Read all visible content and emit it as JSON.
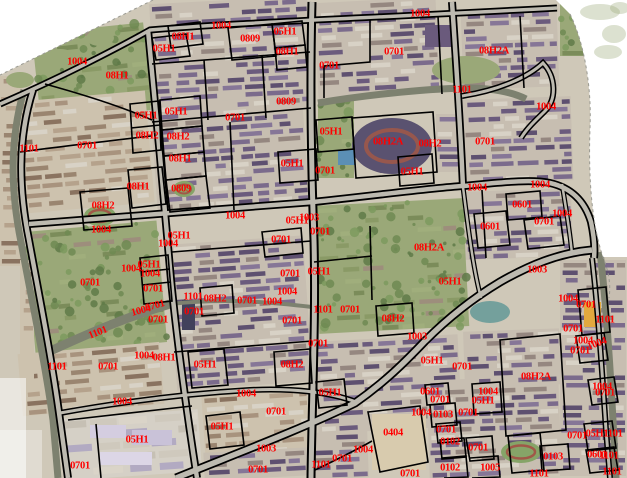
{
  "map": {
    "description": "Cadastral parcel code map overlaid on aerial orthophoto",
    "label_color": "#ff0000",
    "boundary_color": "#000000",
    "background_color": "#ffffff",
    "road_fill": "#bdbab0",
    "canal_fill": "#7d816f",
    "ground_fill": "#cfc8b8",
    "labels": [
      [
        "1004",
        77,
        62
      ],
      [
        "08H1",
        117,
        76
      ],
      [
        "05H1",
        164,
        49
      ],
      [
        "08H1",
        183,
        37
      ],
      [
        "1004",
        221,
        26
      ],
      [
        "0809",
        250,
        39
      ],
      [
        "05H1",
        285,
        32
      ],
      [
        "08H1",
        287,
        52
      ],
      [
        "0701",
        329,
        66
      ],
      [
        "1004",
        420,
        14
      ],
      [
        "0701",
        394,
        52
      ],
      [
        "08H2A",
        494,
        51
      ],
      [
        "1101",
        462,
        90
      ],
      [
        "1004",
        546,
        107
      ],
      [
        "0809",
        286,
        102
      ],
      [
        "05H1",
        146,
        116
      ],
      [
        "05H1",
        176,
        112
      ],
      [
        "0701",
        235,
        118
      ],
      [
        "08H2",
        147,
        136
      ],
      [
        "08H2",
        178,
        137
      ],
      [
        "1101",
        29,
        149
      ],
      [
        "0701",
        87,
        146
      ],
      [
        "08H1",
        180,
        159
      ],
      [
        "05H1",
        331,
        132
      ],
      [
        "08H2A",
        388,
        142
      ],
      [
        "08H2",
        430,
        144
      ],
      [
        "0701",
        485,
        142
      ],
      [
        "05H1",
        292,
        164
      ],
      [
        "0701",
        325,
        171
      ],
      [
        "05H1",
        412,
        172
      ],
      [
        "08H1",
        138,
        187
      ],
      [
        "0809",
        181,
        189
      ],
      [
        "1004",
        477,
        188
      ],
      [
        "1004",
        540,
        185
      ],
      [
        "08H2",
        103,
        206
      ],
      [
        "0601",
        522,
        205
      ],
      [
        "1004",
        562,
        214
      ],
      [
        "0701",
        544,
        222
      ],
      [
        "1004",
        235,
        216
      ],
      [
        "1003",
        309,
        218
      ],
      [
        "05H1",
        297,
        221
      ],
      [
        "0601",
        490,
        227
      ],
      [
        "1004",
        101,
        230
      ],
      [
        "05H1",
        179,
        236
      ],
      [
        "0701",
        281,
        240
      ],
      [
        "1004",
        168,
        244
      ],
      [
        "0701",
        320,
        232
      ],
      [
        "08H2A",
        429,
        248
      ],
      [
        "05H1",
        149,
        265
      ],
      [
        "1004",
        131,
        269
      ],
      [
        "1003",
        537,
        270
      ],
      [
        "05H1",
        319,
        272
      ],
      [
        "1004",
        150,
        274
      ],
      [
        "0701",
        290,
        274
      ],
      [
        "0701",
        90,
        283
      ],
      [
        "05H1",
        450,
        282
      ],
      [
        "0701",
        153,
        289
      ],
      [
        "1004",
        287,
        292
      ],
      [
        "1101",
        193,
        297
      ],
      [
        "08H2",
        215,
        299
      ],
      [
        "1004",
        568,
        299
      ],
      [
        "0701",
        247,
        301
      ],
      [
        "1004",
        272,
        302
      ],
      [
        "0701",
        586,
        305
      ],
      [
        "0701",
        155,
        306,
        -15
      ],
      [
        "1101",
        323,
        310
      ],
      [
        "0701",
        350,
        310
      ],
      [
        "1004",
        141,
        311,
        -15
      ],
      [
        "0701",
        194,
        312
      ],
      [
        "08H2",
        393,
        319
      ],
      [
        "1101",
        605,
        320
      ],
      [
        "0701",
        158,
        320
      ],
      [
        "0701",
        292,
        321
      ],
      [
        "0701",
        573,
        329
      ],
      [
        "1101",
        98,
        333,
        -22
      ],
      [
        "1003",
        417,
        337
      ],
      [
        "1004",
        583,
        341
      ],
      [
        "1004",
        597,
        344,
        -20
      ],
      [
        "0701",
        318,
        344
      ],
      [
        "0701",
        580,
        351
      ],
      [
        "1004",
        144,
        356
      ],
      [
        "08H1",
        164,
        358
      ],
      [
        "05H1",
        432,
        361
      ],
      [
        "05H1",
        205,
        365
      ],
      [
        "08H2",
        292,
        365
      ],
      [
        "1101",
        57,
        367
      ],
      [
        "0701",
        108,
        367
      ],
      [
        "0701",
        462,
        367
      ],
      [
        "08H2A",
        536,
        377
      ],
      [
        "1004",
        602,
        387
      ],
      [
        "05H1",
        330,
        393
      ],
      [
        "0601",
        430,
        392
      ],
      [
        "0701",
        605,
        393
      ],
      [
        "1004",
        246,
        394
      ],
      [
        "0701",
        440,
        400
      ],
      [
        "1004",
        488,
        392
      ],
      [
        "05H1",
        483,
        401
      ],
      [
        "1004",
        122,
        402
      ],
      [
        "0701",
        276,
        412
      ],
      [
        "1004",
        421,
        413
      ],
      [
        "0103",
        443,
        415
      ],
      [
        "0701",
        468,
        413
      ],
      [
        "05H1",
        222,
        427
      ],
      [
        "0701",
        446,
        430
      ],
      [
        "0404",
        393,
        433
      ],
      [
        "05H1",
        597,
        434
      ],
      [
        "1101",
        613,
        434
      ],
      [
        "0701",
        577,
        436
      ],
      [
        "05H1",
        137,
        440
      ],
      [
        "0102",
        450,
        442
      ],
      [
        "0701",
        478,
        448
      ],
      [
        "1003",
        266,
        449
      ],
      [
        "1004",
        363,
        450
      ],
      [
        "0601",
        597,
        455
      ],
      [
        "1101",
        609,
        456
      ],
      [
        "0103",
        553,
        457
      ],
      [
        "0701",
        342,
        459
      ],
      [
        "1101",
        321,
        465
      ],
      [
        "0701",
        80,
        466
      ],
      [
        "0102",
        450,
        468
      ],
      [
        "1005",
        490,
        468
      ],
      [
        "0701",
        258,
        470
      ],
      [
        "1101",
        612,
        472
      ],
      [
        "0701",
        410,
        474
      ],
      [
        "1101",
        539,
        474
      ]
    ],
    "roads": [
      [
        "M0,104 C60,78 118,48 150,30 C230,23 350,19 557,8",
        7,
        3.5
      ],
      [
        "M33,90 C17,140 19,190 29,240 C40,300 52,360 60,420 L68,478",
        8,
        4.5
      ],
      [
        "M148,30 C156,110 164,200 171,280 C178,350 188,420 197,478",
        8,
        4.5
      ],
      [
        "M312,2 C310,80 311,160 314,240 C316,320 312,400 311,478",
        9,
        5
      ],
      [
        "M452,2 C456,60 460,120 463,187",
        8,
        4.5
      ],
      [
        "M29,224 C120,217 220,209 313,202 C380,195 430,188 463,186 C505,182 532,179 550,183 C572,188 585,202 591,222 C594,236 595,248 594,258",
        8,
        4.5
      ],
      [
        "M176,478 C230,456 300,430 355,403 C385,382 405,362 425,341 C445,321 470,300 500,282 C528,266 558,253 592,250",
        9,
        5.5
      ],
      [
        "M60,413 C110,404 180,394 250,390 C292,388 330,392 356,402",
        6,
        3
      ],
      [
        "M592,258 C598,310 602,370 606,430 L610,478",
        6,
        3
      ],
      [
        "M462,96 C500,90 528,77 543,63 C556,77 557,99 545,111 C536,120 527,128 521,138",
        6,
        3
      ],
      [
        "M463,187 C469,235 474,272 481,298",
        5,
        2.5
      ],
      [
        "M562,184 C566,208 570,232 572,254",
        5,
        2.5
      ]
    ],
    "canals": [
      [
        "M24,90 C9,142 11,192 21,242 C32,302 45,362 53,420 L58,478",
        7
      ],
      [
        "M46,353 C85,335 126,317 170,304",
        9
      ],
      [
        "M170,304 C225,298 270,302 312,307",
        4
      ],
      [
        "M318,103 C360,96 420,89 465,88 C492,88 512,92 526,99",
        7
      ],
      [
        "M600,252 C607,310 611,380 614,440 L616,478",
        7
      ]
    ],
    "boundaries": [
      "M45,84 C85,95 125,108 152,120",
      "M152,38 L186,34 L190,56 L156,60 Z",
      "M168,26 L200,22 L203,44 L171,48 Z",
      "M20,152 C65,146 108,141 151,136",
      "M80,192 L128,188 L132,226 L84,230 Z",
      "M128,170 L162,167 L166,204 L132,208 Z",
      "M152,64 L310,52",
      "M228,28 L272,24 L276,56 L232,60 Z",
      "M272,24 L302,21 L305,45 L275,48 Z",
      "M275,48 L305,45 L307,67 L277,70 Z",
      "M152,122 L311,108",
      "M262,55 L266,118",
      "M204,60 L208,120",
      "M160,100 L200,96 L202,126 L162,130 Z",
      "M162,130 L202,126 L204,152 L164,156 Z",
      "M164,156 L204,152 L206,176 L166,180 Z",
      "M166,180 L206,176 L210,208 L170,212 Z",
      "M130,104 L159,101 L161,150 L133,153 Z",
      "M131,128 L160,125",
      "M230,122 L234,210",
      "M370,20 L370,62 L324,66 L324,98",
      "M438,16 L442,94",
      "M520,16 L524,88",
      "M352,118 L433,112 L437,172 L356,178 Z",
      "M316,120 L352,117 L354,149 L318,152 Z",
      "M398,157 L432,154 L434,183 L400,186 Z",
      "M278,152 L316,149 L318,180 L280,183 Z",
      "M482,190 L486,258",
      "M506,194 L540,191 L542,217 L508,220 Z",
      "M524,220 L560,216 L564,245 L528,249 Z",
      "M474,214 L506,211 L510,245 L478,248 Z",
      "M172,252 L311,241",
      "M200,288 L232,285 L234,313 L202,316 Z",
      "M262,232 L301,228 L303,253 L265,257 Z",
      "M140,258 L168,255 L172,301 L144,304 Z",
      "M141,272 L170,269",
      "M142,285 L171,282",
      "M174,352 L312,341",
      "M188,352 L224,349 L228,385 L192,388 Z",
      "M274,352 L310,349 L312,383 L276,386 Z",
      "M370,226 L372,300",
      "M376,306 L412,303 L414,333 L378,336 Z",
      "M314,262 L372,256",
      "M68,420 L192,406",
      "M96,424 L101,478",
      "M206,416 L240,412 L244,445 L210,449 Z",
      "M316,382 L344,379 L347,405 L319,408 Z",
      "M368,412 L420,406 L428,462 L380,472 Z",
      "M315,470 C340,458 358,449 372,441",
      "M425,385 L448,383 L450,403 L427,405 Z",
      "M430,405 L455,403 L457,425 L432,427 Z",
      "M436,424 L460,422 L462,441 L438,443 Z",
      "M440,440 L464,438 L466,457 L442,459 Z",
      "M442,458 L466,456 L468,477 L444,478",
      "M466,438 L492,436 L494,459 L470,461 Z",
      "M470,458 L498,456 L500,477 L472,478",
      "M472,384 L500,382 L502,412 L474,414 Z",
      "M500,340 L560,334 L566,430 L506,436 Z",
      "M540,446 L568,444 L570,469 L542,471 Z",
      "M508,436 L540,433 L544,470 L512,473 Z",
      "M578,290 L606,287 L610,332 L582,335 Z",
      "M576,336 L604,333 L608,360 L580,363 Z",
      "M588,380 L614,377 L618,402 L592,405 Z",
      "M584,424 L612,421 L616,448 L588,451 Z",
      "M586,450 L614,447 L618,470 L590,473 Z"
    ],
    "features": [
      {
        "type": "ellipse",
        "x": 20,
        "y": 80,
        "rx": 14,
        "ry": 8,
        "fill": "#9aa878",
        "name": "tree-patch"
      },
      {
        "type": "ellipse",
        "x": 60,
        "y": 58,
        "rx": 16,
        "ry": 9,
        "fill": "#9aa878",
        "name": "tree-patch"
      },
      {
        "type": "ellipse",
        "x": 100,
        "y": 38,
        "rx": 14,
        "ry": 8,
        "fill": "#9aa878",
        "name": "tree-patch"
      },
      {
        "type": "ellipse",
        "x": 466,
        "y": 70,
        "rx": 34,
        "ry": 14,
        "fill": "#9aa878",
        "name": "tree-patch"
      },
      {
        "type": "ellipse",
        "x": 392,
        "y": 146,
        "rx": 40,
        "ry": 28,
        "fill": "#5a5270",
        "name": "stadium"
      },
      {
        "type": "ellipse",
        "x": 392,
        "y": 146,
        "rx": 26,
        "ry": 16,
        "fill": "none",
        "stroke": "#97574d",
        "sw": 4,
        "name": "stadium-track"
      },
      {
        "type": "ellipse",
        "x": 100,
        "y": 216,
        "rx": 16,
        "ry": 10,
        "fill": "#86a468",
        "name": "school-field"
      },
      {
        "type": "ellipse",
        "x": 100,
        "y": 216,
        "rx": 11,
        "ry": 6,
        "fill": "none",
        "stroke": "#a05848",
        "sw": 2.5,
        "name": "running-track"
      },
      {
        "type": "ellipse",
        "x": 184,
        "y": 189,
        "rx": 11,
        "ry": 8,
        "fill": "#86a468",
        "name": "school-field"
      },
      {
        "type": "ellipse",
        "x": 184,
        "y": 189,
        "rx": 7,
        "ry": 4.5,
        "fill": "none",
        "stroke": "#a05848",
        "sw": 2,
        "name": "running-track"
      },
      {
        "type": "ellipse",
        "x": 521,
        "y": 452,
        "rx": 20,
        "ry": 11,
        "fill": "#86a468",
        "name": "school-field"
      },
      {
        "type": "ellipse",
        "x": 521,
        "y": 452,
        "rx": 14,
        "ry": 6.5,
        "fill": "none",
        "stroke": "#a05848",
        "sw": 2.5,
        "name": "running-track"
      },
      {
        "type": "rect",
        "x": 338,
        "y": 150,
        "w": 17,
        "h": 15,
        "fill": "#5b8fb5",
        "name": "swimming-pool"
      },
      {
        "type": "ellipse",
        "x": 490,
        "y": 312,
        "rx": 20,
        "ry": 11,
        "fill": "#74a09c",
        "name": "pond"
      },
      {
        "type": "rect",
        "x": 584,
        "y": 302,
        "w": 17,
        "h": 25,
        "fill": "#e2a93e",
        "name": "yellow-building"
      },
      {
        "type": "rect",
        "x": 182,
        "y": 300,
        "w": 13,
        "h": 30,
        "fill": "#41415c",
        "name": "dark-building"
      },
      {
        "type": "rect",
        "x": 90,
        "y": 425,
        "w": 36,
        "h": 13,
        "fill": "#d4cde0",
        "name": "large-building"
      },
      {
        "type": "rect",
        "x": 132,
        "y": 430,
        "w": 40,
        "h": 15,
        "fill": "#c9c2d8",
        "name": "large-building"
      },
      {
        "type": "rect",
        "x": 100,
        "y": 452,
        "w": 52,
        "h": 13,
        "fill": "#dcd6e6",
        "name": "large-building"
      },
      {
        "type": "rect",
        "x": 425,
        "y": 25,
        "w": 30,
        "h": 22,
        "fill": "#6a5a7c",
        "name": "large-building"
      }
    ],
    "photo_blocks": [
      [
        36,
        28,
        112,
        88,
        -6,
        "g"
      ],
      [
        152,
        0,
        158,
        112,
        -3,
        "p"
      ],
      [
        316,
        0,
        122,
        96,
        -3,
        "p"
      ],
      [
        462,
        10,
        96,
        78,
        -2,
        "p"
      ],
      [
        560,
        0,
        66,
        56,
        0,
        "g"
      ],
      [
        20,
        96,
        130,
        112,
        -5,
        "b"
      ],
      [
        154,
        100,
        152,
        112,
        -4,
        "p"
      ],
      [
        318,
        100,
        36,
        78,
        0,
        "g"
      ],
      [
        436,
        114,
        24,
        58,
        0,
        "p"
      ],
      [
        464,
        98,
        108,
        84,
        -2,
        "p"
      ],
      [
        464,
        190,
        108,
        68,
        -2,
        "p"
      ],
      [
        30,
        226,
        132,
        122,
        -5,
        "g"
      ],
      [
        172,
        240,
        136,
        146,
        -4,
        "p"
      ],
      [
        316,
        202,
        150,
        128,
        -3,
        "g"
      ],
      [
        20,
        348,
        142,
        62,
        -5,
        "b"
      ],
      [
        62,
        414,
        138,
        62,
        -4,
        "l"
      ],
      [
        204,
        392,
        106,
        82,
        -4,
        "b"
      ],
      [
        316,
        338,
        144,
        92,
        -3,
        "p"
      ],
      [
        372,
        414,
        54,
        56,
        0,
        "t"
      ],
      [
        428,
        378,
        132,
        98,
        -2,
        "p"
      ],
      [
        464,
        330,
        96,
        56,
        -2,
        "p"
      ],
      [
        560,
        260,
        66,
        216,
        0,
        "p"
      ],
      [
        310,
        432,
        58,
        46,
        -2,
        "p"
      ],
      [
        0,
        76,
        22,
        190,
        0,
        "b"
      ],
      [
        204,
        450,
        106,
        28,
        -3,
        "p"
      ],
      [
        20,
        260,
        14,
        120,
        0,
        "b"
      ]
    ],
    "edge": {
      "wedges": [
        "M0,0 L153,0 L0,75 Z",
        "M556,0 L627,0 L627,257 L603,257 C593,228 588,184 590,128 C592,84 583,40 570,14 Z"
      ],
      "fades": [
        [
          0,
          378,
          26,
          100,
          0.55
        ],
        [
          0,
          430,
          42,
          48,
          0.35
        ]
      ],
      "corner_blobs": [
        [
          600,
          12,
          20,
          8
        ],
        [
          614,
          34,
          12,
          9
        ],
        [
          620,
          8,
          10,
          6
        ],
        [
          608,
          52,
          14,
          7
        ]
      ],
      "dashes": [
        "M153,0 L0,75",
        "M570,14 C583,40 592,84 590,128 C588,184 593,228 603,257 C609,272 611,286 609,298"
      ]
    }
  }
}
